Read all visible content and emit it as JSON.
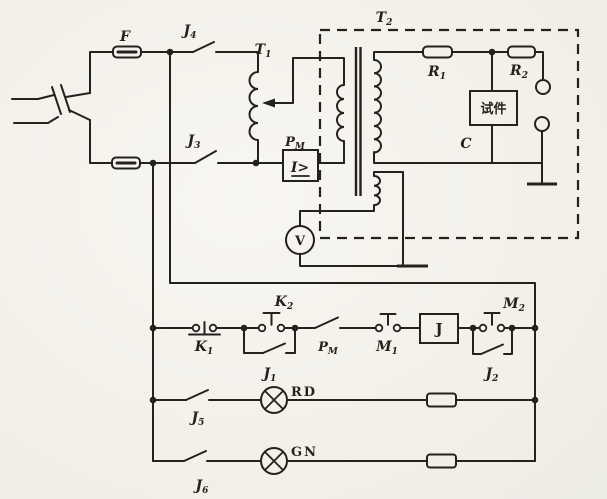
{
  "palette": {
    "paper": "#f6f4ef",
    "ink": "#24221d"
  },
  "supply": {
    "fuse_label": "F",
    "switch_top": {
      "base": "J",
      "sub": "4"
    },
    "switch_bottom": {
      "base": "J",
      "sub": "3"
    }
  },
  "regulator": {
    "label": {
      "base": "T",
      "sub": "1"
    }
  },
  "test_transformer": {
    "label": {
      "base": "T",
      "sub": "2"
    }
  },
  "overcurrent_relay": {
    "label": {
      "base": "P",
      "sub": "M"
    },
    "symbol": "I>"
  },
  "hv_circuit": {
    "r1": {
      "base": "R",
      "sub": "1"
    },
    "r2": {
      "base": "R",
      "sub": "2"
    },
    "specimen": "试件",
    "capacitance": "C"
  },
  "meter": {
    "voltmeter": "V"
  },
  "control": {
    "k1": {
      "base": "K",
      "sub": "1"
    },
    "k2": {
      "base": "K",
      "sub": "2"
    },
    "j1": {
      "base": "J",
      "sub": "1"
    },
    "pm_contact": {
      "base": "P",
      "sub": "M"
    },
    "m1": {
      "base": "M",
      "sub": "1"
    },
    "relay_coil": "J",
    "m2": {
      "base": "M",
      "sub": "2"
    },
    "j2": {
      "base": "J",
      "sub": "2"
    }
  },
  "signal_lamps": {
    "j5": {
      "base": "J",
      "sub": "5"
    },
    "red_lamp": "RD",
    "j6": {
      "base": "J",
      "sub": "6"
    },
    "green_lamp": "GN"
  }
}
